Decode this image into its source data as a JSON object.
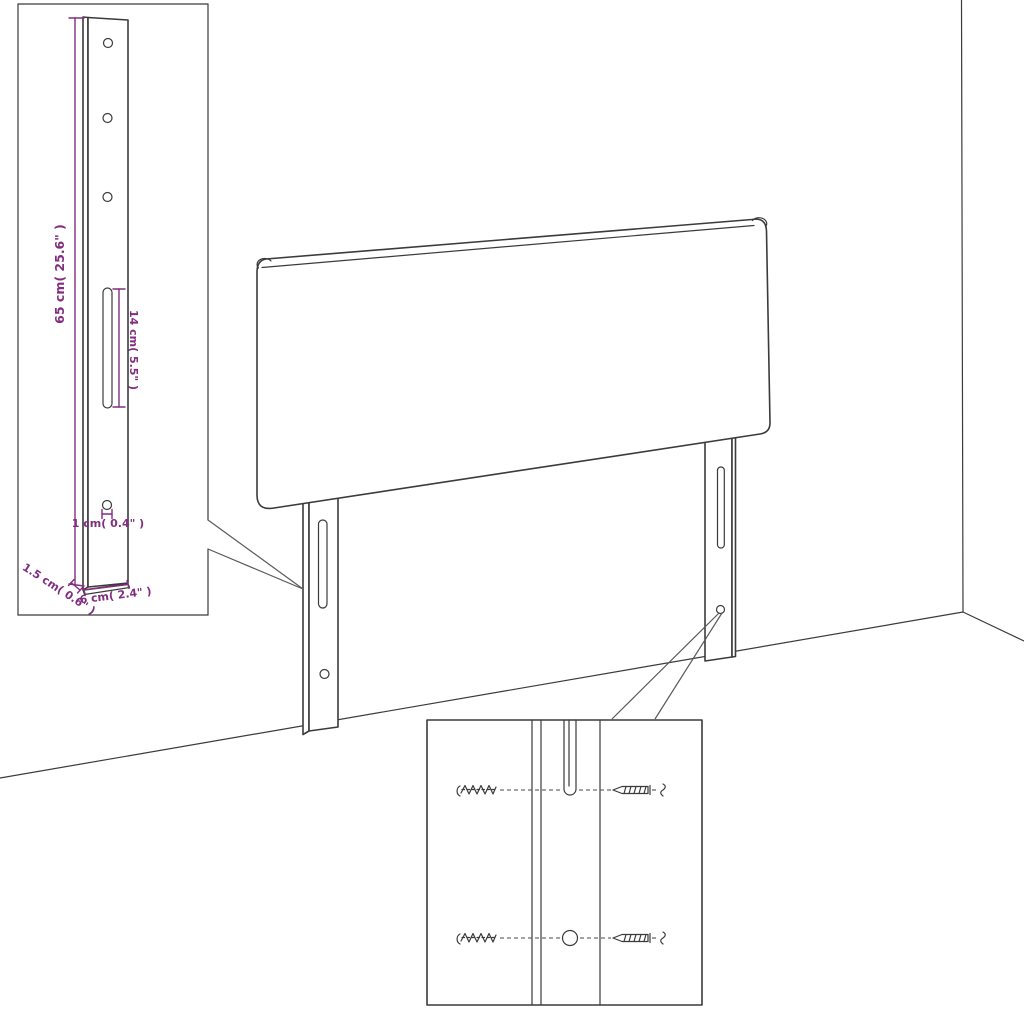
{
  "diagram": {
    "title": "headboard-dimension-diagram",
    "subject": "upholstered headboard with two adjustable mounting legs in room corner",
    "colors": {
      "background": "#ffffff",
      "outline": "#3b3b3b",
      "dimension": "#822e80"
    },
    "bracket_detail": {
      "holes_top_count": 3,
      "dimensions": {
        "height": {
          "label": "65 cm( 25.6\" )"
        },
        "slot_length": {
          "label": "14 cm( 5.5\" )"
        },
        "hole_diameter": {
          "label": "1 cm( 0.4\" )"
        },
        "thickness": {
          "label": "1.5 cm( 0.6\" )"
        },
        "width": {
          "label": "6 cm( 2.4\" )"
        }
      }
    },
    "hardware_detail": {
      "rows": 2,
      "items": [
        "wall-plug",
        "screw"
      ]
    },
    "main_view": {
      "legs": 2,
      "slots_per_leg": 1,
      "holes_per_leg": 1
    }
  }
}
